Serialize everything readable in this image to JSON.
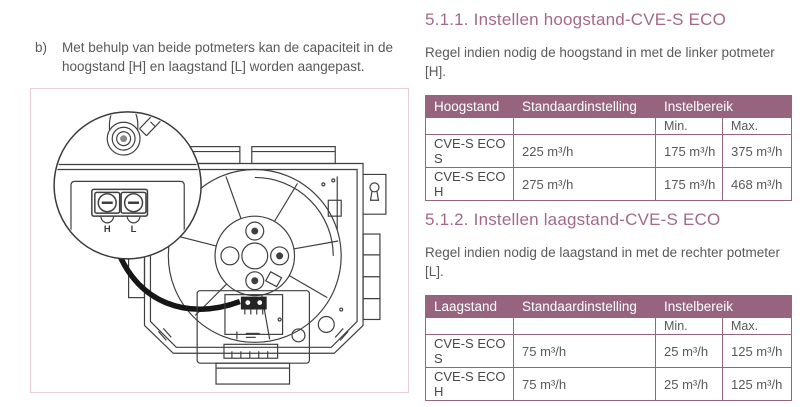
{
  "colors": {
    "heading": "#a4698a",
    "table_header_bg": "#96647e",
    "table_border": "#96647e",
    "body_text": "#58595b",
    "diagram_frame": "#e8cdd9"
  },
  "intro": {
    "marker": "b)",
    "text": "Met behulp van beide potmeters kan de capaciteit in de hoogstand [H] en laagstand [L] worden aangepast."
  },
  "diagram": {
    "pot_high_label": "H",
    "pot_low_label": "L"
  },
  "sections": [
    {
      "heading": "5.1.1. Instellen hoogstand-CVE-S ECO",
      "body": "Regel indien nodig de hoogstand in met de linker potmeter [H].",
      "table": {
        "col1": "Hoogstand",
        "col2": "Standaardinstelling",
        "col34": "Instelbereik",
        "min": "Min.",
        "max": "Max.",
        "rows": [
          {
            "model": "CVE-S ECO S",
            "standard": "225 m³/h",
            "min": "175 m³/h",
            "max": "375 m³/h"
          },
          {
            "model": "CVE-S ECO H",
            "standard": "275 m³/h",
            "min": "175 m³/h",
            "max": "468 m³/h"
          }
        ]
      }
    },
    {
      "heading": "5.1.2. Instellen laagstand-CVE-S ECO",
      "body": "Regel indien nodig de laagstand in met de rechter potmeter [L].",
      "table": {
        "col1": "Laagstand",
        "col2": "Standaardinstelling",
        "col34": "Instelbereik",
        "min": "Min.",
        "max": "Max.",
        "rows": [
          {
            "model": "CVE-S ECO S",
            "standard": "75 m³/h",
            "min": "25 m³/h",
            "max": "125 m³/h"
          },
          {
            "model": "CVE-S ECO H",
            "standard": "75 m³/h",
            "min": "25 m³/h",
            "max": "125 m³/h"
          }
        ]
      }
    }
  ]
}
